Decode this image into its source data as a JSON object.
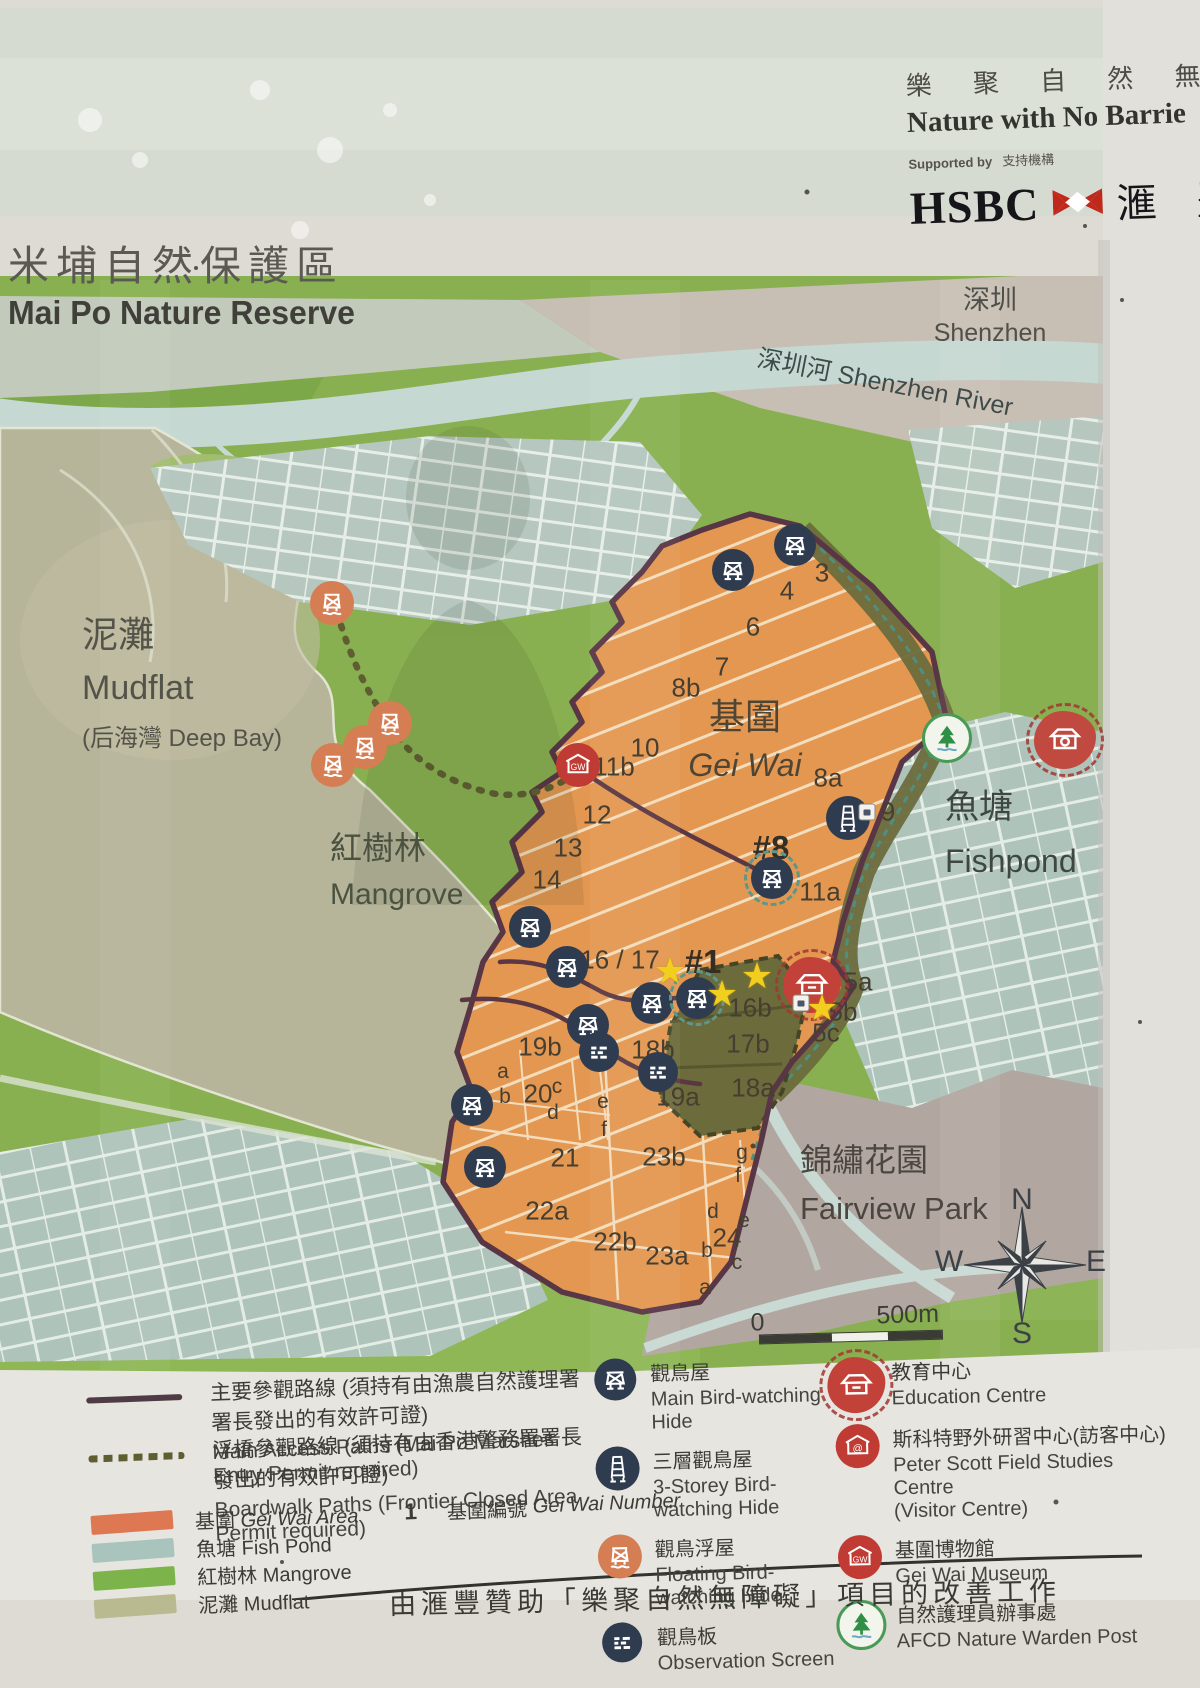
{
  "header": {
    "slogan_zh": "樂 聚 自 然 無 障",
    "slogan_en": "Nature with No Barrie",
    "supported_by_en": "Supported by",
    "supported_by_zh": "支持機構",
    "hsbc_en": "HSBC",
    "hsbc_zh": "滙 豐"
  },
  "title": {
    "zh": "米埔自然保護區",
    "en": "Mai Po Nature Reserve"
  },
  "map": {
    "regions": {
      "shenzhen": {
        "zh": "深圳",
        "en": "Shenzhen"
      },
      "river": {
        "label": "深圳河 Shenzhen River"
      },
      "mudflat": {
        "zh": "泥灘",
        "en": "Mudflat",
        "sub": "(后海灣 Deep Bay)"
      },
      "mangrove": {
        "zh": "紅樹林",
        "en": "Mangrove"
      },
      "geiwai": {
        "zh": "基圍",
        "en": "Gei Wai"
      },
      "fishpond": {
        "zh": "魚塘",
        "en": "Fishpond"
      },
      "fairview": {
        "zh": "錦繡花園",
        "en": "Fairview Park"
      }
    },
    "gei_wai_numbers": [
      {
        "t": "3",
        "x": 822,
        "y": 573
      },
      {
        "t": "4",
        "x": 787,
        "y": 591
      },
      {
        "t": "6",
        "x": 753,
        "y": 627
      },
      {
        "t": "7",
        "x": 722,
        "y": 667
      },
      {
        "t": "8b",
        "x": 686,
        "y": 688
      },
      {
        "t": "10",
        "x": 645,
        "y": 748
      },
      {
        "t": "11b",
        "x": 614,
        "y": 767
      },
      {
        "t": "8a",
        "x": 828,
        "y": 778
      },
      {
        "t": "9",
        "x": 888,
        "y": 812
      },
      {
        "t": "12",
        "x": 597,
        "y": 815
      },
      {
        "t": "13",
        "x": 568,
        "y": 848
      },
      {
        "t": "#8",
        "x": 771,
        "y": 848,
        "b": 1
      },
      {
        "t": "14",
        "x": 547,
        "y": 880
      },
      {
        "t": "11a",
        "x": 820,
        "y": 892
      },
      {
        "t": "16 / 17",
        "x": 620,
        "y": 960
      },
      {
        "t": "#1",
        "x": 703,
        "y": 962,
        "b": 1
      },
      {
        "t": "5a",
        "x": 858,
        "y": 982
      },
      {
        "t": "16b",
        "x": 750,
        "y": 1008
      },
      {
        "t": "5b",
        "x": 843,
        "y": 1012
      },
      {
        "t": "5c",
        "x": 826,
        "y": 1033
      },
      {
        "t": "17b",
        "x": 748,
        "y": 1044
      },
      {
        "t": "19b",
        "x": 540,
        "y": 1047
      },
      {
        "t": "18b",
        "x": 653,
        "y": 1050
      },
      {
        "t": "a",
        "x": 503,
        "y": 1072,
        "s": 1
      },
      {
        "t": "c",
        "x": 557,
        "y": 1087,
        "s": 1
      },
      {
        "t": "18a",
        "x": 753,
        "y": 1088
      },
      {
        "t": "20",
        "x": 538,
        "y": 1094
      },
      {
        "t": "b",
        "x": 505,
        "y": 1097,
        "s": 1
      },
      {
        "t": "19a",
        "x": 678,
        "y": 1097
      },
      {
        "t": "e",
        "x": 603,
        "y": 1102,
        "s": 1
      },
      {
        "t": "d",
        "x": 553,
        "y": 1113,
        "s": 1
      },
      {
        "t": "f",
        "x": 604,
        "y": 1130,
        "s": 1
      },
      {
        "t": "g",
        "x": 742,
        "y": 1153,
        "s": 1
      },
      {
        "t": "21",
        "x": 565,
        "y": 1158
      },
      {
        "t": "23b",
        "x": 664,
        "y": 1157
      },
      {
        "t": "f",
        "x": 738,
        "y": 1176,
        "s": 1
      },
      {
        "t": "22a",
        "x": 547,
        "y": 1211
      },
      {
        "t": "d",
        "x": 713,
        "y": 1212,
        "s": 1
      },
      {
        "t": "e",
        "x": 744,
        "y": 1221,
        "s": 1
      },
      {
        "t": "24",
        "x": 727,
        "y": 1238
      },
      {
        "t": "22b",
        "x": 615,
        "y": 1242
      },
      {
        "t": "b",
        "x": 707,
        "y": 1251,
        "s": 1
      },
      {
        "t": "23a",
        "x": 667,
        "y": 1256
      },
      {
        "t": "c",
        "x": 737,
        "y": 1263,
        "s": 1
      },
      {
        "t": "a",
        "x": 705,
        "y": 1288,
        "s": 1
      }
    ],
    "icons": [
      {
        "type": "main-hide",
        "x": 795,
        "y": 545
      },
      {
        "type": "main-hide",
        "x": 733,
        "y": 570
      },
      {
        "type": "main-hide",
        "x": 530,
        "y": 927
      },
      {
        "type": "main-hide",
        "x": 567,
        "y": 967
      },
      {
        "type": "main-hide",
        "x": 588,
        "y": 1025
      },
      {
        "type": "main-hide",
        "x": 652,
        "y": 1003
      },
      {
        "type": "main-hide",
        "x": 472,
        "y": 1105
      },
      {
        "type": "main-hide",
        "x": 485,
        "y": 1167
      },
      {
        "type": "ring-hide",
        "x": 772,
        "y": 878
      },
      {
        "type": "ring-hide",
        "x": 697,
        "y": 998
      },
      {
        "type": "storey-hide",
        "x": 848,
        "y": 818
      },
      {
        "type": "screen",
        "x": 599,
        "y": 1052
      },
      {
        "type": "screen",
        "x": 658,
        "y": 1072
      },
      {
        "type": "float-hide",
        "x": 332,
        "y": 603
      },
      {
        "type": "float-hide",
        "x": 390,
        "y": 723
      },
      {
        "type": "float-hide",
        "x": 365,
        "y": 747
      },
      {
        "type": "float-hide",
        "x": 333,
        "y": 765
      },
      {
        "type": "museum",
        "x": 578,
        "y": 765
      },
      {
        "type": "education",
        "x": 812,
        "y": 985
      },
      {
        "type": "camera",
        "x": 1065,
        "y": 740
      },
      {
        "type": "tree",
        "x": 947,
        "y": 738
      },
      {
        "type": "star",
        "x": 670,
        "y": 971
      },
      {
        "type": "star",
        "x": 757,
        "y": 976
      },
      {
        "type": "star",
        "x": 722,
        "y": 994
      },
      {
        "type": "star",
        "x": 822,
        "y": 1008
      },
      {
        "type": "pmark",
        "x": 867,
        "y": 812
      },
      {
        "type": "pmark",
        "x": 801,
        "y": 1003
      }
    ],
    "compass": {
      "n": "N",
      "e": "E",
      "s": "S",
      "w": "W"
    },
    "scale": {
      "start": "0",
      "end": "500m"
    }
  },
  "legend": {
    "paths": [
      {
        "style": "solid",
        "zh": "主要參觀路線 (須持有由漁農自然護理署署長發出的有效許可證)",
        "en": "Main Access Paths (Mai Po Marshes Entry Permit required)"
      },
      {
        "style": "dashed",
        "zh": "浮橋參觀路線 (須持有由香港警務署署長發出的有效許可證)",
        "en": "Boardwalk Paths (Frontier Closed Area Permit required)"
      }
    ],
    "areas": [
      {
        "key": "geiwai_swatch",
        "zh": "基圍",
        "en": "Gei Wai Area",
        "it": 1
      },
      {
        "key": "fishpond_swatch",
        "zh": "魚塘",
        "en": "Fish Pond"
      },
      {
        "key": "mangrove_swatch",
        "zh": "紅樹林",
        "en": "Mangrove"
      },
      {
        "key": "mudflat_swatch",
        "zh": "泥灘",
        "en": "Mudflat"
      }
    ],
    "area_number": {
      "num": "1",
      "zh": "基圍編號",
      "en": "Gei Wai Number"
    },
    "hides": [
      {
        "type": "main-hide",
        "zh": "觀鳥屋",
        "en": "Main Bird-watching Hide"
      },
      {
        "type": "storey-hide",
        "zh": "三層觀鳥屋",
        "en": "3-Storey Bird-watching Hide"
      },
      {
        "type": "float-hide",
        "zh": "觀鳥浮屋",
        "en": "Floating Bird-watching Hide"
      },
      {
        "type": "screen",
        "zh": "觀鳥板",
        "en": "Observation Screen"
      }
    ],
    "facilities": [
      {
        "type": "education",
        "zh": "教育中心",
        "en": "Education Centre"
      },
      {
        "type": "visitor",
        "zh": "斯科特野外研習中心(訪客中心)",
        "en": "Peter Scott Field Studies Centre",
        "en2": "(Visitor Centre)"
      },
      {
        "type": "museum",
        "zh": "基圍博物館",
        "en": "Gei Wai Museum"
      },
      {
        "type": "tree",
        "zh": "自然護理員辦事處",
        "en": "AFCD Nature Warden Post"
      }
    ]
  },
  "footer": {
    "text": "由滙豐贊助「樂聚自然無障礙」項目的改善工作"
  },
  "icon_glyphs": {
    "museum_text": "GW",
    "visitor_text": "@"
  },
  "colors": {
    "geiwai_swatch": "#dd7853",
    "fishpond_swatch": "#a9c4bc",
    "mangrove_swatch": "#7cb34a",
    "mudflat_swatch": "#b9ba90",
    "geiwai_area": "#e39750",
    "boundary": "#583646",
    "hsbc_red": "#c0281c",
    "hide_navy": "#2f3c50",
    "facility_red": "#bf3b33",
    "tree_green": "#2f8f46"
  }
}
